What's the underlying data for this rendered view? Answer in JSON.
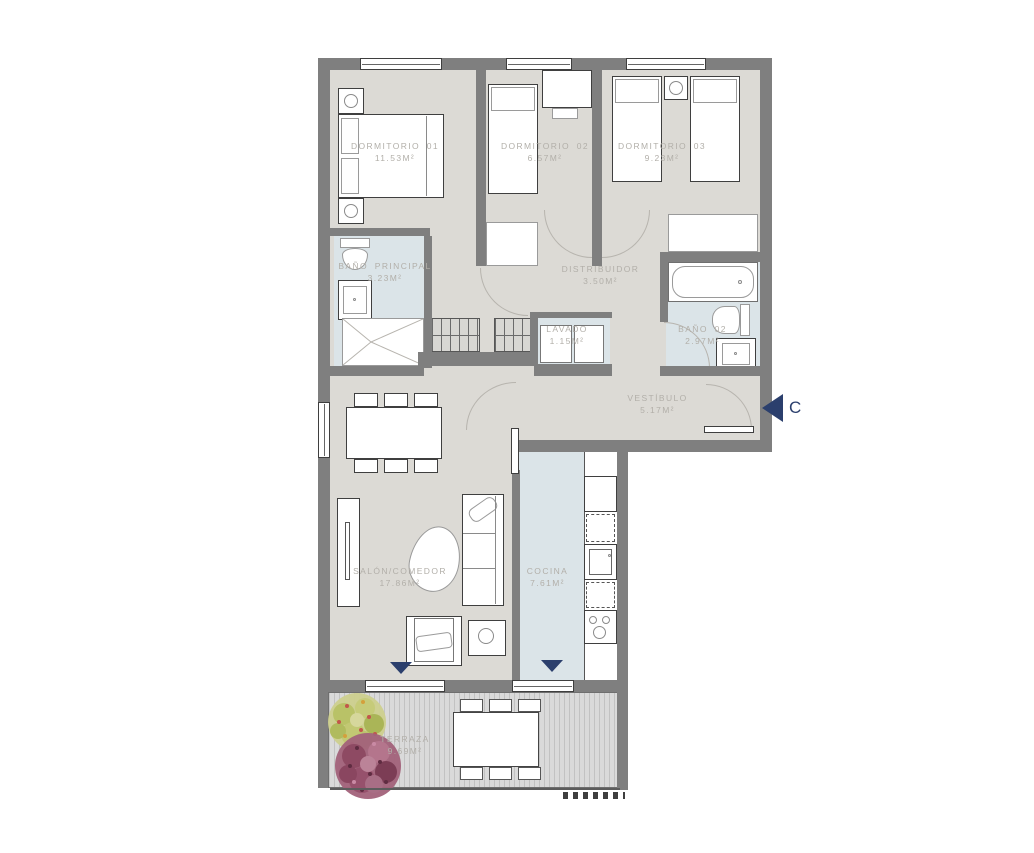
{
  "plan": {
    "type": "apartment-floor-plan",
    "colors": {
      "wall": "#7f7f7f",
      "floor": "#dcdad5",
      "wet_floor": "#dbe4e8",
      "label_text": "#b2afa9",
      "accent_navy": "#2b3f6d",
      "deck": "#d9d9d9"
    }
  },
  "rooms": [
    {
      "id": "dormitorio-01",
      "name": "DORMITORIO 01",
      "area": "11.53m²"
    },
    {
      "id": "dormitorio-02",
      "name": "DORMITORIO 02",
      "area": "6.57m²"
    },
    {
      "id": "dormitorio-03",
      "name": "DORMITORIO 03",
      "area": "9.23m²"
    },
    {
      "id": "bano-principal",
      "name": "BAÑO PRINCIPAL",
      "area": "3.23m²"
    },
    {
      "id": "distribuidor",
      "name": "DISTRIBUIDOR",
      "area": "3.50m²"
    },
    {
      "id": "lavado",
      "name": "LAVADO",
      "area": "1.15m²"
    },
    {
      "id": "bano-02",
      "name": "BAÑO 02",
      "area": "2.97m²"
    },
    {
      "id": "vestibulo",
      "name": "VESTÍBULO",
      "area": "5.17m²"
    },
    {
      "id": "salon-comedor",
      "name": "SALÓN/COMEDOR",
      "area": "17.86m²"
    },
    {
      "id": "cocina",
      "name": "COCINA",
      "area": "7.61m²"
    },
    {
      "id": "terraza",
      "name": "TERRAZA",
      "area": "9.69m²"
    }
  ],
  "entrance": {
    "letter": "C"
  },
  "icons": {
    "entrance_arrow": "left-triangle",
    "terrace_door_marker": "down-triangle"
  }
}
